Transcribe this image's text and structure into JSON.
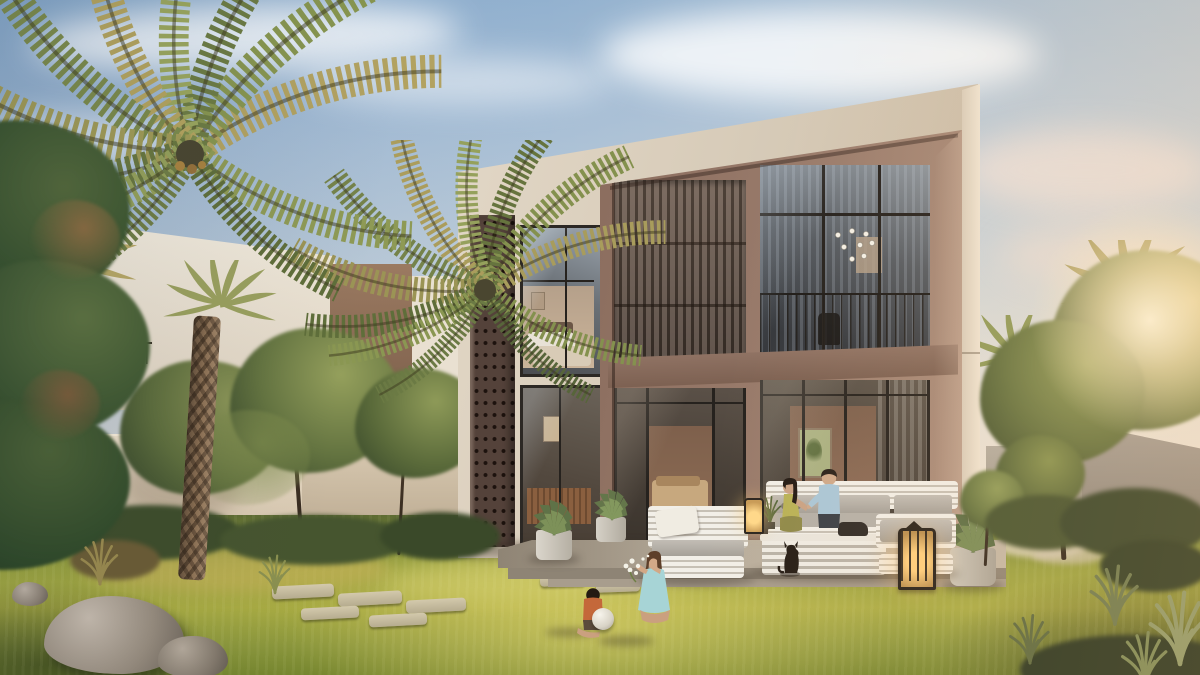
{
  "scene": {
    "alt": "Golden-hour architectural rendering of a modern two-storey villa with timber slat screens, a perforated masonry panel, glass walls, a terrace with white slatted outdoor sofas, lit lanterns, a couple seated with a small dog, two children playing on a sunlit lawn, palm trees, garden walls and rocks",
    "type": "architectural-render",
    "time_of_day": "sunset golden hour",
    "objects": [
      "sky",
      "clouds",
      "sun-glow",
      "neighbor-villa",
      "power-lines",
      "main-villa",
      "perforated-screen",
      "timber-slat-panel",
      "balcony",
      "bedroom-window",
      "glass-doors",
      "terrace",
      "outdoor-armchair",
      "outdoor-sofa",
      "coffee-table",
      "lantern-small",
      "lantern-large",
      "potted-agave",
      "planter",
      "woman-seated",
      "man-seated",
      "dog",
      "girl-with-flowers",
      "boy-with-ball",
      "lawn",
      "stepping-stones",
      "garden-wall-left",
      "garden-wall-right",
      "garden-trees",
      "palm-trees",
      "rocks",
      "ornamental-grass"
    ],
    "people_count": 4,
    "palette": {
      "sky_top": "#8fafce",
      "sky_horizon": "#f4ead9",
      "villa_wall": "#d8ccba",
      "villa_frame": "#96786a",
      "timber_slats": "#6e6057",
      "perforated_screen": "#54423a",
      "window_glass": "#4c5056",
      "terrace_concrete": "#b3a898",
      "grass_sunlit": "#b5b149",
      "grass_shade": "#55632f",
      "foliage_olive": "#5d6d3c",
      "palm_frond_gold": "#b3a35e",
      "garden_wall_left": "#e6dac5",
      "garden_wall_right": "#9a948a",
      "lantern_glow": "#ffcf7d",
      "boy_shirt": "#c4683a",
      "girl_dress": "#a7d4d6",
      "man_shirt": "#aac7d8",
      "woman_dress": "#b9b257"
    }
  }
}
